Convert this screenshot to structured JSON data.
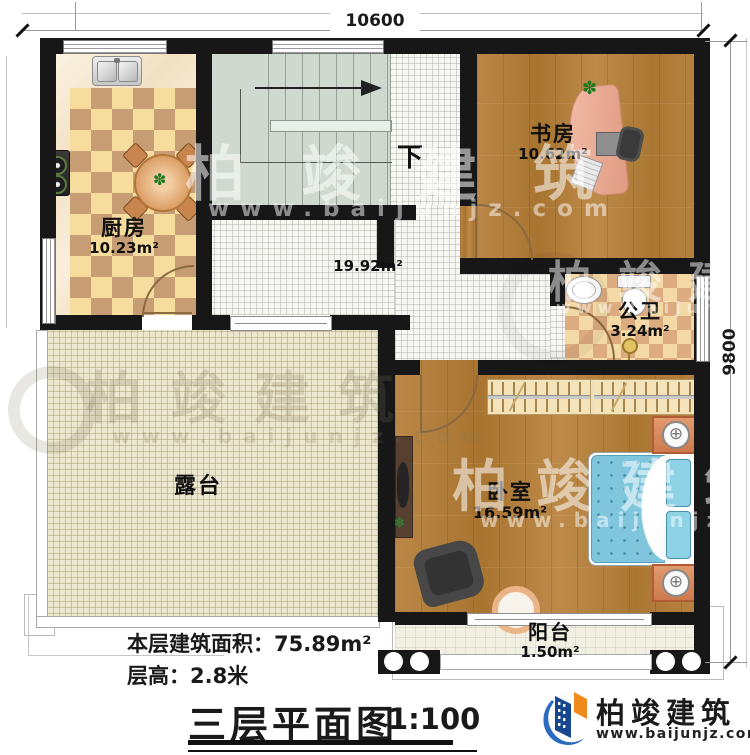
{
  "dimensions": {
    "top": "10600",
    "right": "9800"
  },
  "rooms": {
    "kitchen": {
      "name": "厨房",
      "area": "10.23m²"
    },
    "study": {
      "name": "书房",
      "area": "10.62m²"
    },
    "bathroom": {
      "name": "公卫",
      "area": "3.24m²"
    },
    "bedroom": {
      "name": "卧室",
      "area": "16.59m²"
    },
    "balcony": {
      "name": "阳台",
      "area": "1.50m²"
    },
    "terrace": {
      "name": "露台"
    },
    "hall": {
      "area": "19.92m²"
    }
  },
  "stairs": {
    "down_label": "下"
  },
  "footer": {
    "building_area": "本层建筑面积：75.89m²",
    "floor_height": "层高：2.8米",
    "title": "三层平面图",
    "scale": "1:100"
  },
  "brand": {
    "name": "柏竣建筑",
    "website": "www.baijunjz.com"
  },
  "watermark": {
    "name": "柏竣建筑",
    "website": "www.baijunjz.com"
  },
  "icons": {
    "plant": "✽",
    "lamp": "⊕"
  },
  "colors": {
    "wall": "#171717",
    "logo_blue": "#2a6abf",
    "logo_dark_blue": "#17478f",
    "logo_orange": "#f08a1d",
    "wood": "#b6813f",
    "stairs": "#cfd9cf"
  }
}
